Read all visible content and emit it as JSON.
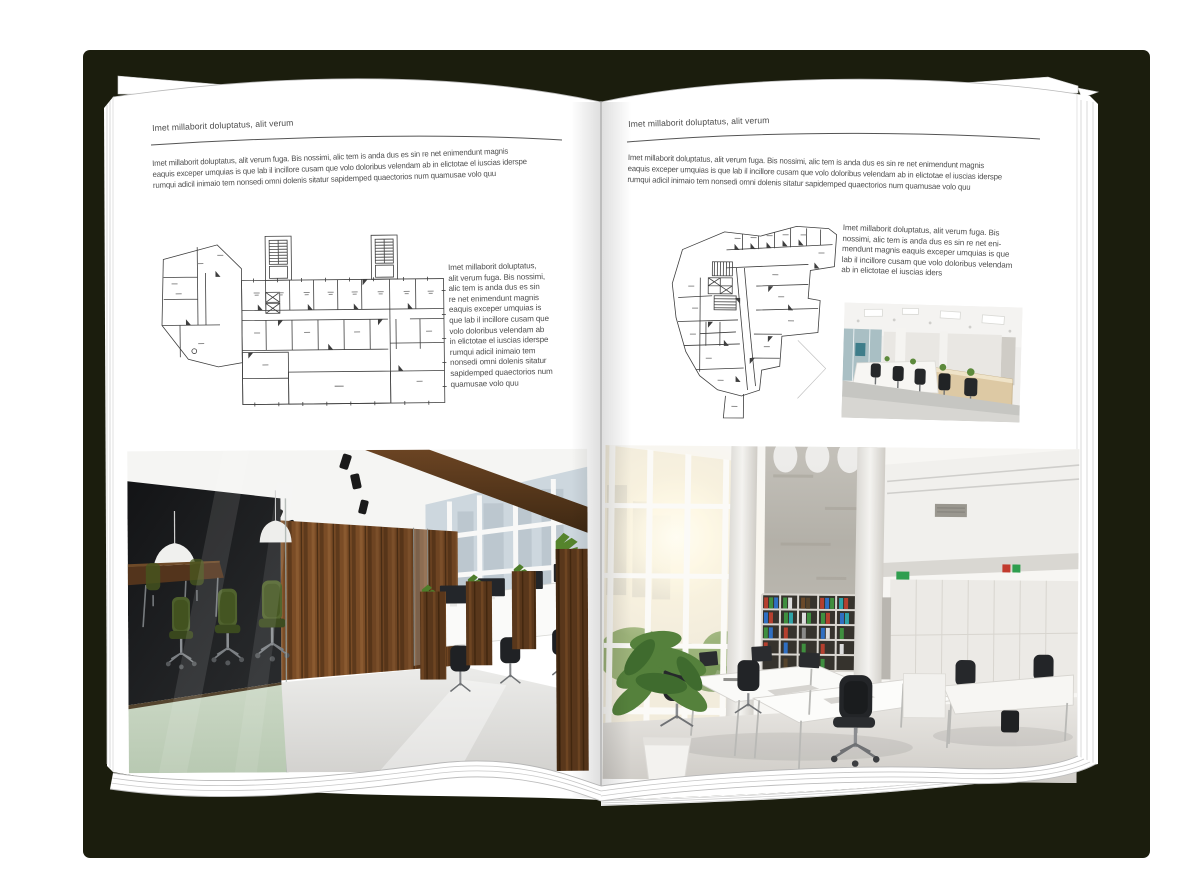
{
  "canvas": {
    "background": "#ffffff"
  },
  "book": {
    "cover_color": "#1b1d0d",
    "page_color": "#ffffff"
  },
  "left_page": {
    "header": "Imet millaborit doluptatus, alit verum",
    "intro": "Imet millaborit doluptatus, alit verum fuga. Bis nossimi, alic tem is anda dus es sin re net enimendunt magnis\neaquis exceper umquias is que lab il incillore cusam que volo doloribus velendam ab in elictotae el iuscias iderspe\nrumqui adicil inimaio tem nonsedi omni dolenis sitatur sapidemped quaectorios num quamusae volo quu",
    "side_text": "Imet millaborit doluptatus,\nalit verum fuga. Bis nossimi,\nalic tem is anda dus es sin\nre net enimendunt magnis\neaquis exceper umquias is\nque lab il incillore cusam que\nvolo doloribus velendam ab\nin elictotae el iuscias iderspe\nrumqui adicil inimaio tem\nnonsedi omni dolenis sitatur\nsapidemped quaectorios num\nquamusae volo quu",
    "floor_plan": "rectangular office building floor plan with two stair towers",
    "photo": "office interior with glass meeting room, green chairs and wood wall"
  },
  "right_page": {
    "header": "Imet millaborit doluptatus, alit verum",
    "intro": "Imet millaborit doluptatus, alit verum fuga. Bis nossimi, alic tem is anda dus es sin re net enimendunt magnis\neaquis exceper umquias is que lab il incillore cusam que volo doloribus velendam ab in elictotae el iuscias iderspe\nrumqui adicil inimaio tem nonsedi omni dolenis sitatur sapidemped quaectorios num quamusae volo quu",
    "side_text": "Imet millaborit doluptatus, alit verum fuga. Bis\nnossimi, alic tem is anda dus es sin re net eni-\nmendunt magnis eaquis exceper umquias is que\nlab il incillore cusam que volo doloribus velendam\nab in elictotae el iuscias iders",
    "floor_plan": "irregular wedge-shaped office building floor plan",
    "photo_small": "open plan office with light desks and black chairs",
    "photo_large": "double-height bright office atrium with bookshelf wall"
  }
}
